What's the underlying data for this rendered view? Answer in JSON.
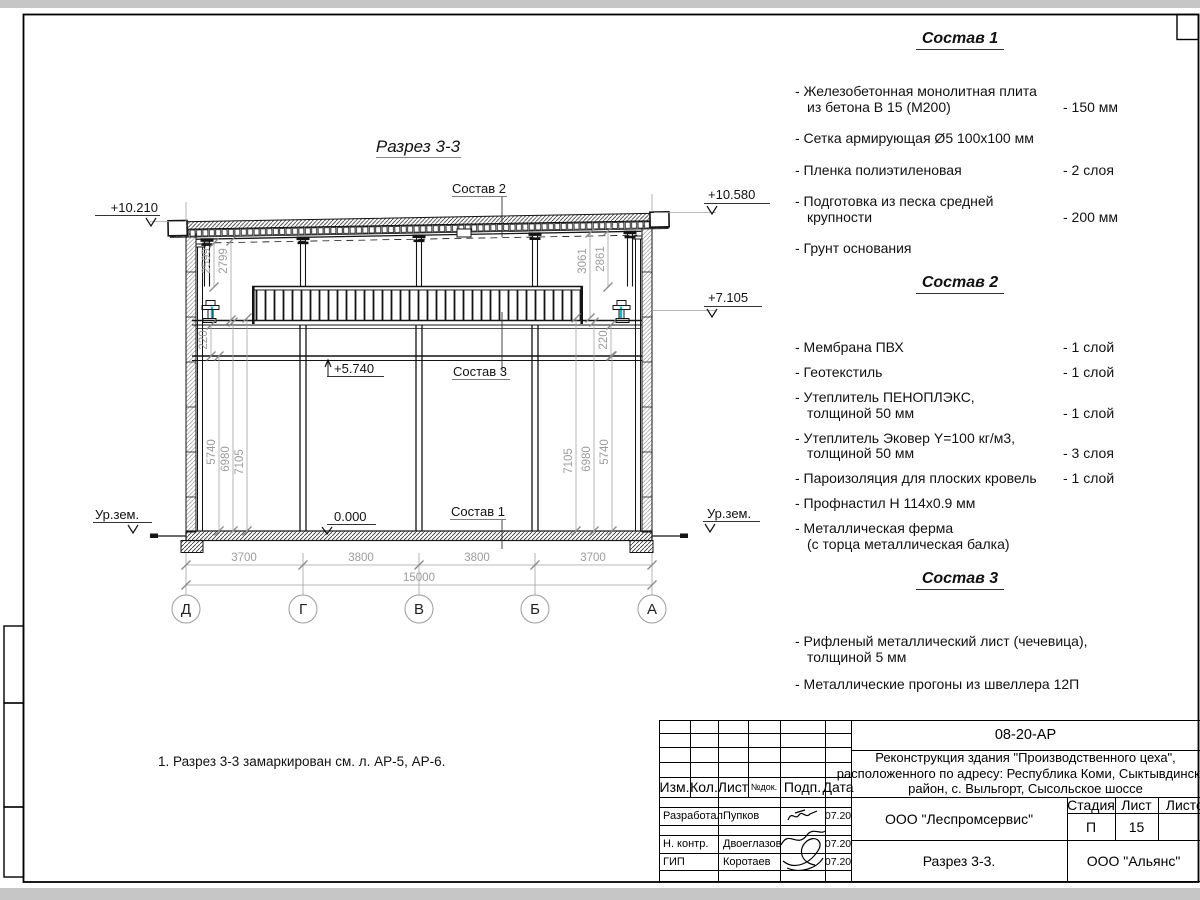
{
  "drawing": {
    "title": "Разрез 3-3",
    "note": "1. Разрез 3-3 замаркирован см. л. АР-5, АР-6.",
    "elev_left_top": "+10.210",
    "elev_right_top": "+10.580",
    "elev_right_mid": "+7.105",
    "elev_mezz": "+5.740",
    "elev_floor": "0.000",
    "ground": "Ур.зем.",
    "dims_bottom": [
      "3700",
      "3800",
      "3800",
      "3700"
    ],
    "dim_total": "15000",
    "axes": [
      "Д",
      "Г",
      "В",
      "Б",
      "А"
    ],
    "dims_left": [
      "5740",
      "6980",
      "7105"
    ],
    "dims_right": [
      "7105",
      "6980",
      "5740"
    ],
    "dims_upper_left": [
      "2599",
      "2799"
    ],
    "dims_upper_right": [
      "3061",
      "2861"
    ],
    "dim_small": "220"
  },
  "compositions": [
    {
      "title": "Состав 1",
      "items": [
        {
          "name": "- Железобетонная  монолитная плита\nиз бетона В 15 (М200)",
          "value": "- 150 мм"
        },
        {
          "name": "- Сетка армирующая Ø5 100х100 мм",
          "value": ""
        },
        {
          "name": "- Пленка полиэтиленовая",
          "value": "-  2 слоя"
        },
        {
          "name": "- Подготовка из песка средней\nкрупности",
          "value": "- 200 мм"
        },
        {
          "name": "- Грунт основания",
          "value": ""
        }
      ]
    },
    {
      "title": "Состав 2",
      "items": [
        {
          "name": "- Мембрана ПВХ",
          "value": "- 1 слой"
        },
        {
          "name": "- Геотекстиль",
          "value": "- 1 слой"
        },
        {
          "name": "- Утеплитель ПЕНОПЛЭКС,\nтолщиной 50 мм",
          "value": "- 1 слой"
        },
        {
          "name": "- Утеплитель Эковер Y=100 кг/м3,\nтолщиной 50 мм",
          "value": "- 3 слоя"
        },
        {
          "name": "- Пароизоляция для плоских кровель",
          "value": "- 1 слой"
        },
        {
          "name": "- Профнастил Н 114х0.9 мм",
          "value": ""
        },
        {
          "name": "- Металлическая ферма\n(с торца металлическая балка)",
          "value": ""
        }
      ]
    },
    {
      "title": "Состав 3",
      "items": [
        {
          "name": "- Рифленый металлический лист (чечевица),\nтолщиной 5 мм",
          "value": ""
        },
        {
          "name": "- Металлические прогоны из швеллера 12П",
          "value": ""
        }
      ]
    }
  ],
  "titleblock": {
    "doc_number": "08-20-АР",
    "project": "Реконструкция здания \"Производственного цеха\",\nрасположенного по адресу: Республика Коми, Сыктывдинский\nрайон, с. Выльгорт, Сысольское шоссе",
    "col_izm": "Изм.",
    "col_kol": "Кол.",
    "col_list": "Лист",
    "col_ndok": "№док.",
    "col_podp": "Подп.",
    "col_data": "Дата",
    "rows": [
      {
        "role": "Разработал",
        "name": "Пупков",
        "date": "07.20"
      },
      {
        "role": "Н. контр.",
        "name": "Двоеглазов",
        "date": "07.20"
      },
      {
        "role": "ГИП",
        "name": "Коротаев",
        "date": "07.20"
      }
    ],
    "organization": "ООО \"Леспромсервис\"",
    "stage_label": "Стадия",
    "sheet_label": "Лист",
    "sheets_label": "Листов",
    "stage": "П",
    "sheet_no": "15",
    "drawing_name": "Разрез 3-3.",
    "contractor": "ООО \"Альянс\""
  },
  "colors": {
    "line": "#1a1a1a",
    "dim": "#a2a2a2",
    "accent": "#17b9c9",
    "page_bg": "#c6c6c6"
  }
}
